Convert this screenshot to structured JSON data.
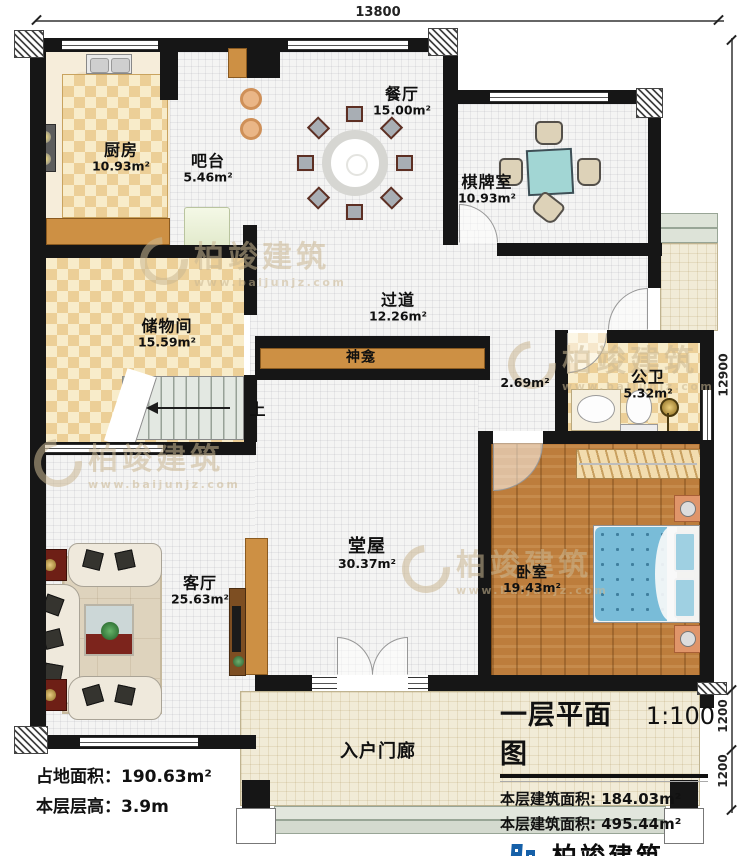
{
  "plan": {
    "dimensions": {
      "top": "13800",
      "right": [
        "12900",
        "1200",
        "1200"
      ]
    },
    "rooms": [
      {
        "id": "kitchen",
        "name": "厨房",
        "area": "10.93m²"
      },
      {
        "id": "bar",
        "name": "吧台",
        "area": "5.46m²"
      },
      {
        "id": "dining",
        "name": "餐厅",
        "area": "15.00m²"
      },
      {
        "id": "chess",
        "name": "棋牌室",
        "area": "10.93m²"
      },
      {
        "id": "storage",
        "name": "储物间",
        "area": "15.59m²"
      },
      {
        "id": "corridor",
        "name": "过道",
        "area": "12.26m²"
      },
      {
        "id": "shrine",
        "name": "神龛",
        "area": "2.69m²"
      },
      {
        "id": "bathroom",
        "name": "公卫",
        "area": "5.32m²"
      },
      {
        "id": "hall",
        "name": "堂屋",
        "area": "30.37m²"
      },
      {
        "id": "living",
        "name": "客厅",
        "area": "25.63m²"
      },
      {
        "id": "bedroom",
        "name": "卧室",
        "area": "19.43m²"
      },
      {
        "id": "porch",
        "name": "入户门廊",
        "area": ""
      }
    ],
    "stairs": {
      "up_label": "上"
    },
    "footer": {
      "land_area_label": "占地面积：",
      "land_area_value": "190.63m²",
      "floor_height_label": "本层层高：",
      "floor_height_value": "3.9m"
    },
    "title_block": {
      "title": "一层平面图",
      "scale": "1:100",
      "area_rows": [
        {
          "label": "本层建筑面积:",
          "value": "184.03m²"
        },
        {
          "label": "本层建筑面积:",
          "value": "495.44m²"
        }
      ]
    },
    "brand": {
      "name": "柏竣建筑",
      "website": "www.baijunjz.com"
    },
    "colors": {
      "wall": "#161616",
      "wood": "#cd9044",
      "checker_dark": "#eccf97",
      "checker_light": "#f8ecca",
      "bed_blue": "#79bcd8",
      "logo_blue": "#1660a8",
      "logo_orange": "#f08300"
    }
  }
}
